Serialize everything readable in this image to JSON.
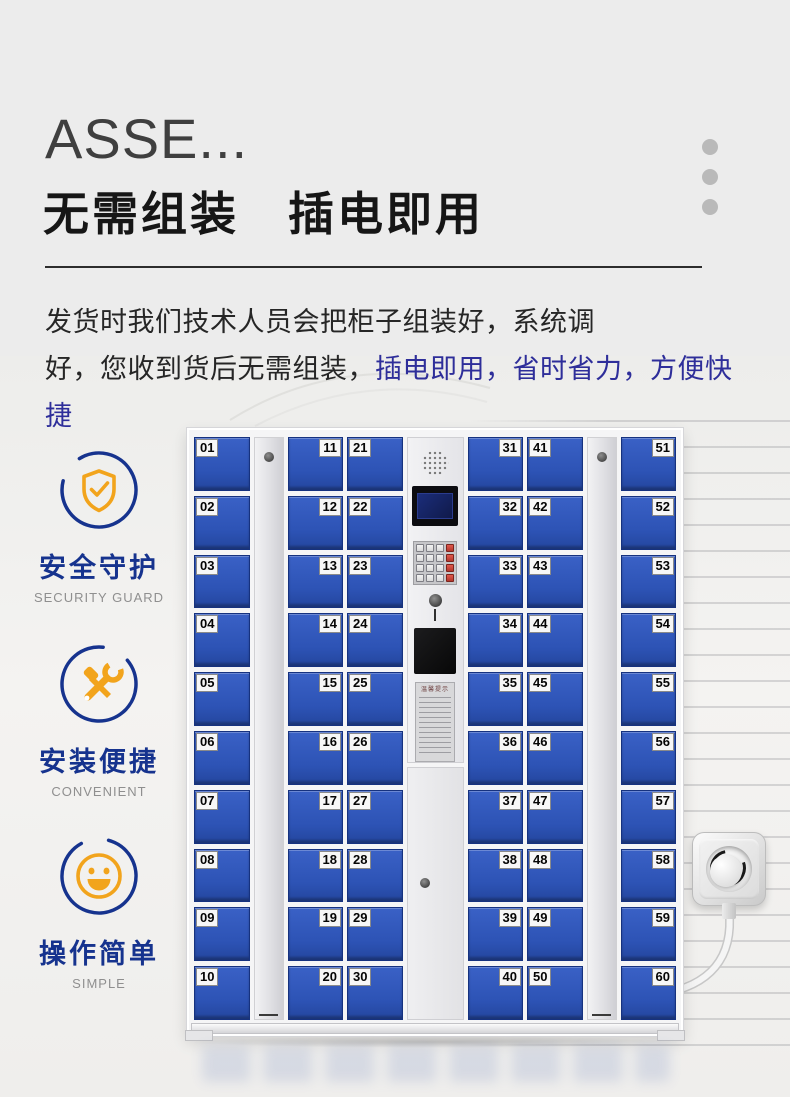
{
  "header": {
    "title_en": "ASSE...",
    "title_cn": "无需组装　插电即用"
  },
  "description": {
    "line1": "发货时我们技术人员会把柜子组装好，系统调",
    "line2_black": "好，您收到货后无需组装，",
    "line2_blue": "插电即用，省时省力，方便快捷",
    "highlight_color": "#2e2e9a"
  },
  "features": [
    {
      "icon": "shield-check-icon",
      "title": "安全守护",
      "subtitle": "SECURITY GUARD"
    },
    {
      "icon": "tools-icon",
      "title": "安装便捷",
      "subtitle": "CONVENIENT"
    },
    {
      "icon": "smiley-icon",
      "title": "操作简单",
      "subtitle": "SIMPLE"
    }
  ],
  "colors": {
    "door_blue": "#2d53b5",
    "feature_blue": "#16338e",
    "feature_orange": "#f2a41c",
    "highlight_text": "#2e2e9a",
    "dot_gray": "#b9b9b9"
  },
  "locker": {
    "door_color": "#2d53b5",
    "control_panel": {
      "notice_title": "温馨提示"
    },
    "columns": [
      {
        "type": "doors",
        "label_side": "left",
        "numbers": [
          "01",
          "02",
          "03",
          "04",
          "05",
          "06",
          "07",
          "08",
          "09",
          "10"
        ]
      },
      {
        "type": "strip"
      },
      {
        "type": "doors",
        "label_side": "right",
        "numbers": [
          "11",
          "12",
          "13",
          "14",
          "15",
          "16",
          "17",
          "18",
          "19",
          "20"
        ]
      },
      {
        "type": "doors",
        "label_side": "left",
        "numbers": [
          "21",
          "22",
          "23",
          "24",
          "25",
          "26",
          "27",
          "28",
          "29",
          "30"
        ]
      },
      {
        "type": "panel"
      },
      {
        "type": "doors",
        "label_side": "right",
        "numbers": [
          "31",
          "32",
          "33",
          "34",
          "35",
          "36",
          "37",
          "38",
          "39",
          "40"
        ]
      },
      {
        "type": "doors",
        "label_side": "left",
        "numbers": [
          "41",
          "42",
          "43",
          "44",
          "45",
          "46",
          "47",
          "48",
          "49",
          "50"
        ]
      },
      {
        "type": "strip"
      },
      {
        "type": "doors",
        "label_side": "right",
        "numbers": [
          "51",
          "52",
          "53",
          "54",
          "55",
          "56",
          "57",
          "58",
          "59",
          "60"
        ]
      }
    ]
  }
}
